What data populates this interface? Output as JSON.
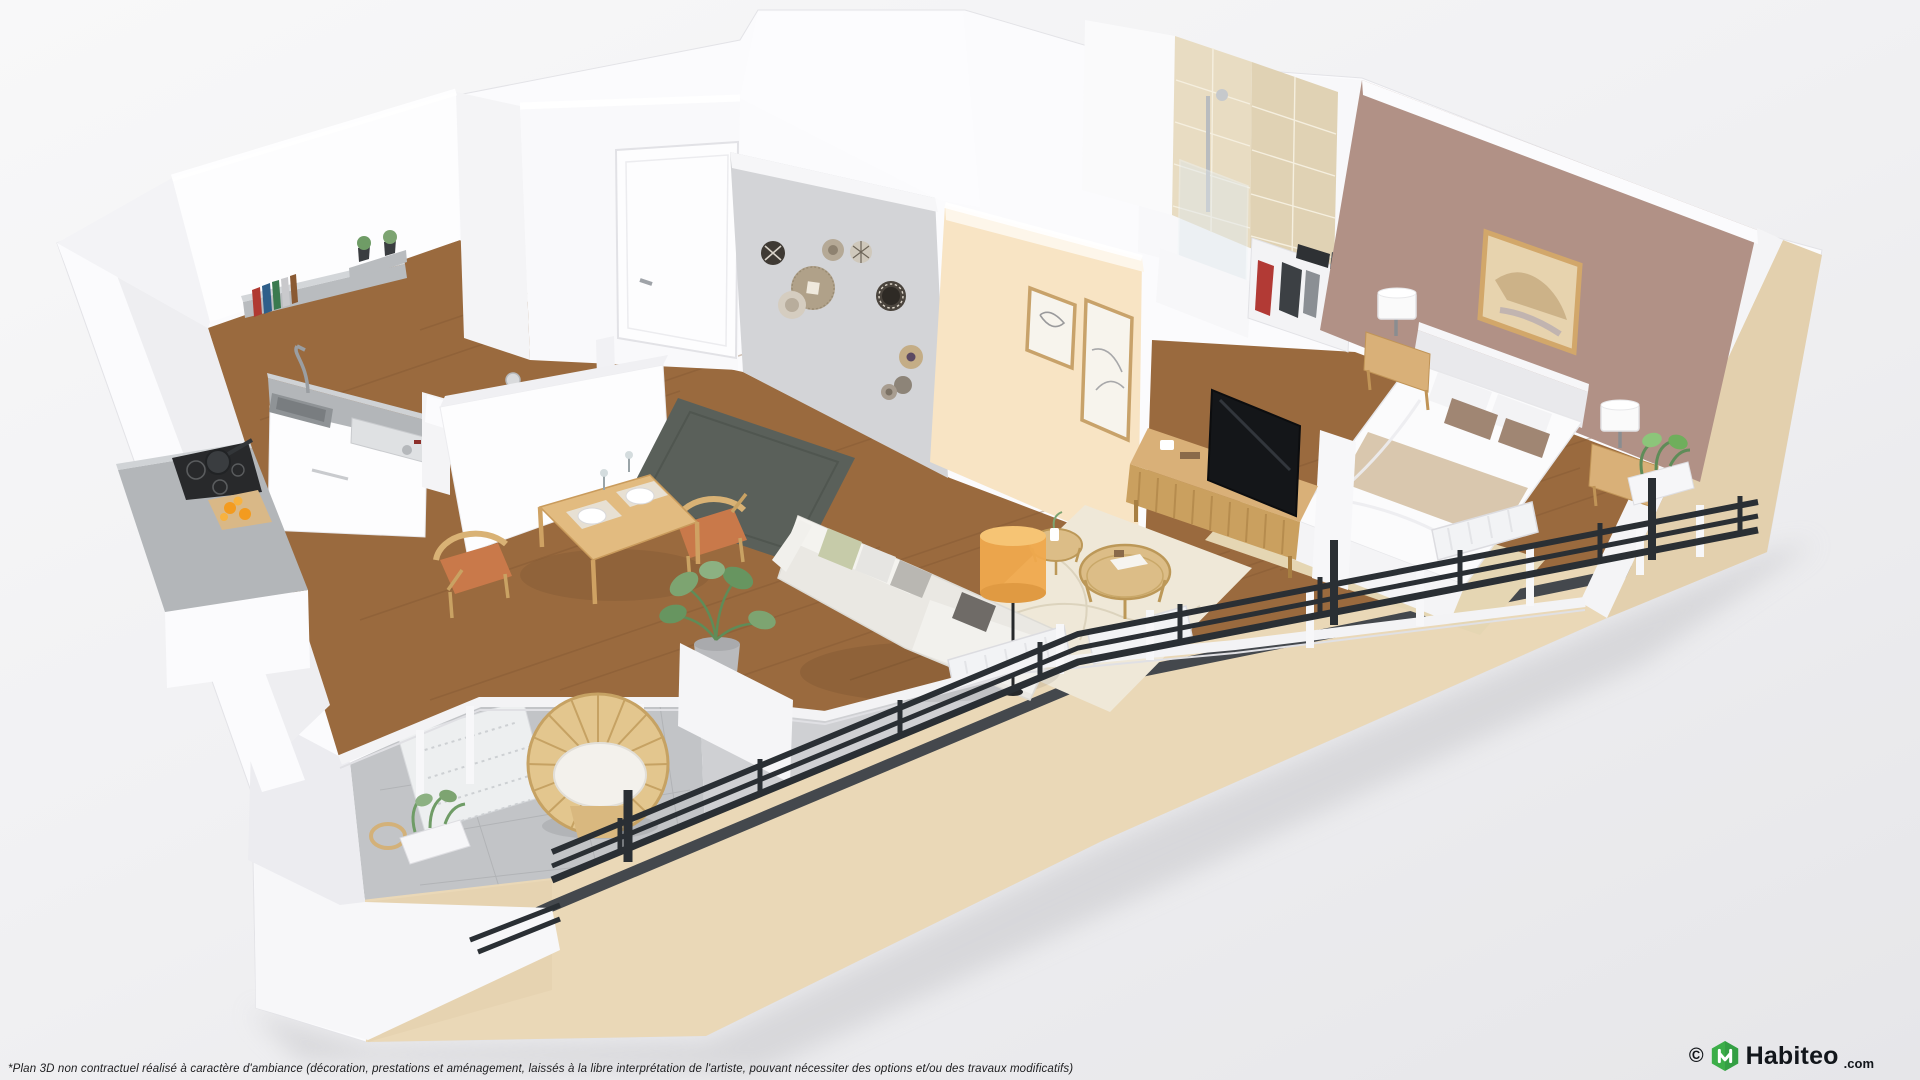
{
  "footer": {
    "disclaimer": "*Plan 3D non contractuel réalisé à caractère d'ambiance (décoration, prestations et aménagement, laissés à la libre interprétation de l'artiste, pouvant nécessiter des options et/ou des travaux modificatifs)"
  },
  "branding": {
    "copyright": "©",
    "name": "Habiteo",
    "tld": ".com"
  },
  "colors": {
    "brand_green": "#3CAE49",
    "brand_green_dark": "#2E9440",
    "facade_beige": "#EAD8B7",
    "stripe_dark": "#44484D",
    "floor_wood": "#9A6A3E",
    "wall_white": "#FBFBFD",
    "wall_gray": "#D3D4D7",
    "wall_peach": "#F8E4C4",
    "wall_mauve": "#B19186",
    "tile_beige": "#E8DCC2",
    "balcony_tile": "#C2C4C7",
    "rug_dark": "#5A605A",
    "rug_cream": "#EFE8D8",
    "rug_sisal": "#E5D6B3",
    "sofa_cream": "#EAE8E3",
    "wood_furniture": "#D9B078",
    "rattan": "#DCBD87",
    "terracotta": "#C9794A",
    "lamp_amber": "#EFA94D",
    "tv_black": "#141619",
    "railing_dark": "#2A2F34",
    "plant_green": "#7DA471"
  },
  "scene": {
    "description": "3D isometric floor plan render of a one-bedroom apartment with wrap-around balcony",
    "rooms": [
      {
        "name": "kitchen",
        "items": [
          "wall shelves with books and plants",
          "sink with faucet",
          "dishwasher",
          "kitchen island",
          "induction hob with pan",
          "cutting board with oranges"
        ]
      },
      {
        "name": "wc",
        "items": [
          "toilet",
          "toilet paper holder",
          "half-height enclosure wall"
        ]
      },
      {
        "name": "entrance",
        "items": [
          "entrance door",
          "woven wall baskets",
          "dark runner rug"
        ]
      },
      {
        "name": "living-room",
        "items": [
          "dining table with two place settings",
          "two wooden chairs",
          "corner sofa with cushions",
          "amber floor lamp",
          "two rattan coffee tables",
          "cream rug",
          "monstera plant",
          "radiators"
        ]
      },
      {
        "name": "bathroom",
        "items": [
          "beige tiled walls",
          "walk-in shower",
          "glass shower screen",
          "open wardrobe with clothes"
        ]
      },
      {
        "name": "bedroom",
        "items": [
          "double bed with beige throw",
          "headboard",
          "framed artwork",
          "two nightstands",
          "two table lamps",
          "TV sideboard",
          "television",
          "radiator"
        ]
      },
      {
        "name": "balcony",
        "items": [
          "rattan lounge chair",
          "rattan side table",
          "planters with greenery",
          "black metal railing",
          "tiled floor with deck grates"
        ]
      }
    ]
  }
}
